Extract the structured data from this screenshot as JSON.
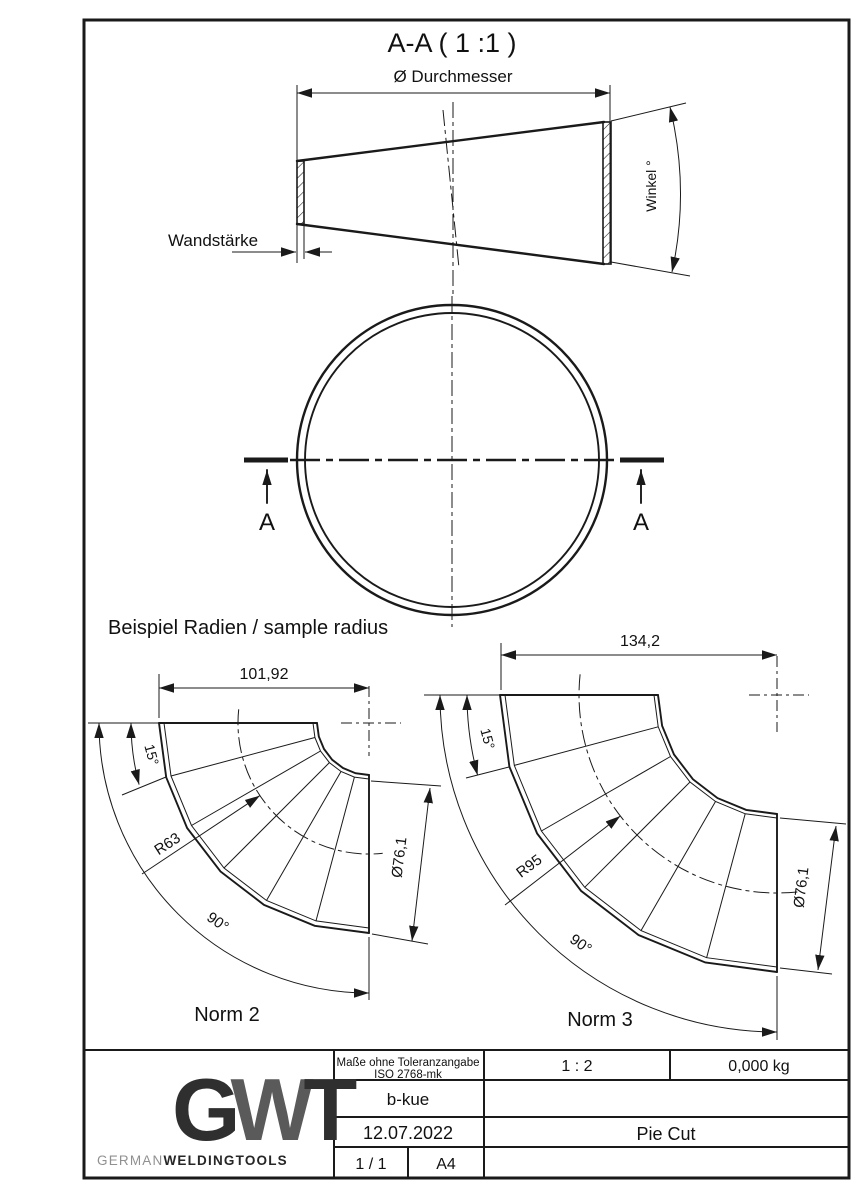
{
  "drawing": {
    "section_title": "A-A ( 1 :1 )",
    "dim_diameter": "Ø Durchmesser",
    "dim_wall": "Wandstärke",
    "dim_angle": "Winkel °",
    "section_mark_left": "A",
    "section_mark_right": "A",
    "samples_heading": "Beispiel Radien / sample radius",
    "norm2": {
      "label": "Norm 2",
      "width": "101,92",
      "seg_angle": "15°",
      "radius": "R63",
      "pipe_dia": "Ø76,1",
      "bend_angle": "90°"
    },
    "norm3": {
      "label": "Norm 3",
      "width": "134,2",
      "seg_angle": "15°",
      "radius": "R95",
      "pipe_dia": "Ø76,1",
      "bend_angle": "90°"
    }
  },
  "title_block": {
    "logo_g": "G",
    "logo_w": "W",
    "logo_t": "T",
    "brand_light": "GERMAN",
    "brand_bold": "WELDINGTOOLS",
    "tolerance_line1": "Maße ohne Toleranzangabe",
    "tolerance_line2": "ISO 2768-mk",
    "scale": "1 : 2",
    "weight": "0,000 kg",
    "creator": "b-kue",
    "date": "12.07.2022",
    "part_title": "Pie Cut",
    "sheet": "1 / 1",
    "paper": "A4"
  },
  "colors": {
    "line": "#1a1a1a",
    "logo_dark": "#2f2f2f",
    "logo_mid": "#5a5a5a",
    "brand_light": "#909090",
    "brand_dark": "#262626"
  }
}
